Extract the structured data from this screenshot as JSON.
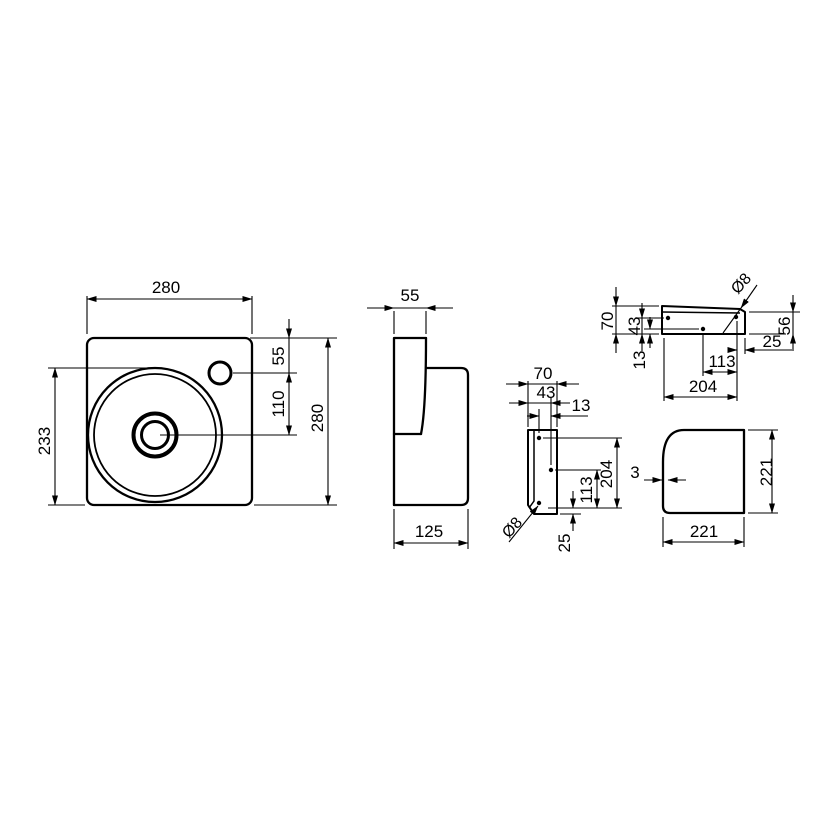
{
  "colors": {
    "line": "#000000",
    "background": "#ffffff"
  },
  "views": {
    "plan": {
      "dim_width": "280",
      "dim_height": "280",
      "dim_tap_from_top": "55",
      "dim_tap_to_bowl_center": "110",
      "dim_bowl_to_bottom": "233"
    },
    "side": {
      "dim_front_rim": "55",
      "dim_depth": "125"
    },
    "bracket_front": {
      "dim_width": "70",
      "dim_hole_offset": "43",
      "dim_hole_offset_2": "13",
      "dim_length": "204",
      "dim_hole_span": "113",
      "dim_hole_to_end": "25",
      "dim_hole_diameter": "Ø8"
    },
    "bracket_top": {
      "dim_width": "70",
      "dim_hole_offset": "43",
      "dim_hole_offset_2": "13",
      "dim_length": "204",
      "dim_hole_span": "113",
      "dim_hole_to_end": "25",
      "dim_height": "56",
      "dim_hole_diameter": "Ø8"
    },
    "back": {
      "dim_width": "221",
      "dim_height": "221",
      "dim_wall_thickness": "3"
    }
  }
}
